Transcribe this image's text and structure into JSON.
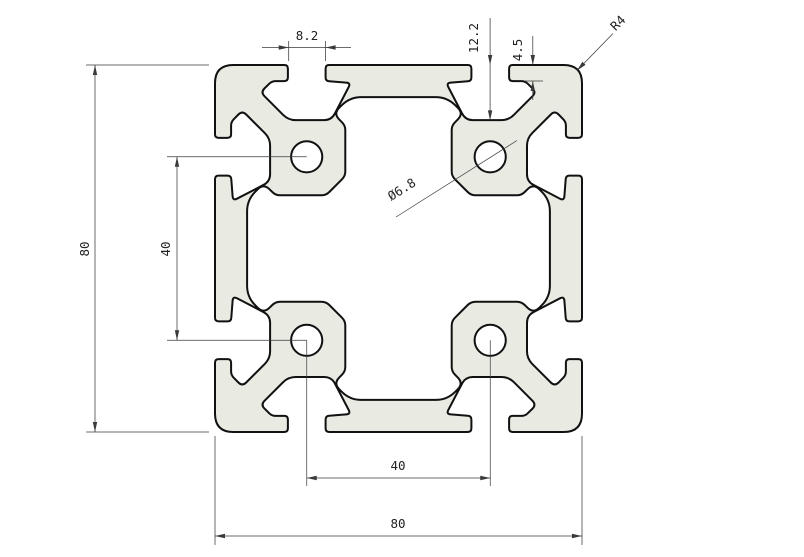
{
  "drawing": {
    "profile_fill": "#e9eae2",
    "outline_color": "#111111",
    "dim_color": "#3a3a3a",
    "dimensions": {
      "slot_opening": "8.2",
      "slot_depth": "12.2",
      "lip_thickness": "4.5",
      "corner_radius": "R4",
      "hole_diameter": "Ø6.8",
      "overall_height": "80",
      "hole_spacing_vertical": "40",
      "hole_spacing_horizontal": "40",
      "overall_width": "80"
    }
  }
}
